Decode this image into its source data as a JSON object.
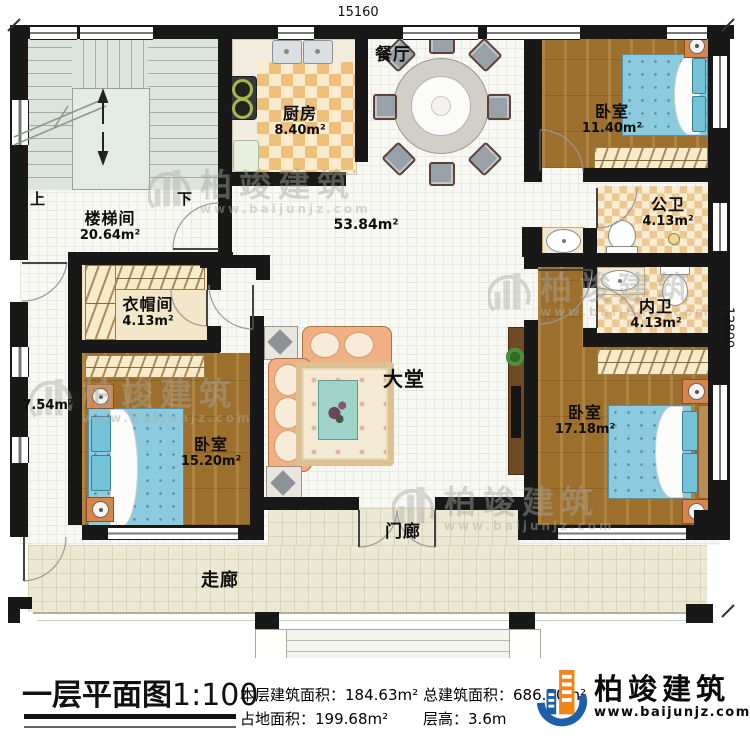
{
  "plan": {
    "dimensions": {
      "width_mm": "15160",
      "height_mm": "12800"
    },
    "rooms": [
      {
        "name": "餐厅",
        "area": ""
      },
      {
        "name": "厨房",
        "area": "8.40m²"
      },
      {
        "name": "卧室",
        "area": "11.40m²"
      },
      {
        "name": "公卫",
        "area": "4.13m²"
      },
      {
        "name": "楼梯间",
        "area": "20.64m²"
      },
      {
        "name": "衣帽间",
        "area": "4.13m²"
      },
      {
        "name": "内卫",
        "area": "4.13m²"
      },
      {
        "name": "大堂",
        "area": "53.84m²"
      },
      {
        "name": "卧室",
        "area": "17.18m²"
      },
      {
        "name": "卧室",
        "area": "15.20m²"
      },
      {
        "name": "门廊",
        "area": ""
      },
      {
        "name": "走廊",
        "area": ""
      },
      {
        "name": "",
        "area": "7.54m²"
      }
    ],
    "stairs": {
      "up": "上",
      "down": "下"
    }
  },
  "watermark": {
    "name": "柏竣建筑",
    "url": "www.baijunjz.com"
  },
  "footer": {
    "title": "一层平面图",
    "scale": "1:100",
    "stats": [
      {
        "label": "本层建筑面积：",
        "value": "184.63m²"
      },
      {
        "label": "占地面积：",
        "value": "199.68m²"
      },
      {
        "label": "总建筑面积：",
        "value": "686.50m²"
      },
      {
        "label": "层高：",
        "value": "3.6m"
      }
    ],
    "brand": {
      "name": "柏竣建筑",
      "url": "www.baijunjz.com"
    }
  }
}
